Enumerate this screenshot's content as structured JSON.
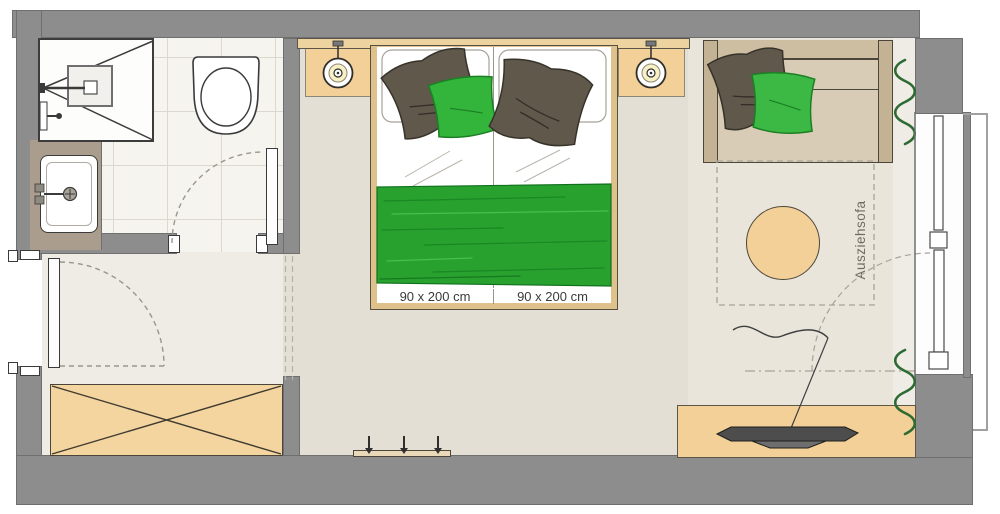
{
  "floor_plan": {
    "bed": {
      "mattress_left_label": "90 x 200 cm",
      "mattress_right_label": "90 x 200 cm"
    },
    "sofa": {
      "label": "Ausziehsofa"
    },
    "colors": {
      "wall_gray": "#8d8d8d",
      "floor_beige": "#e4dfd4",
      "corridor_beige": "#efece6",
      "furniture_tan": "#f2d097",
      "accent_green": "#28a12e",
      "pillow_brown": "#5f584b",
      "curtain_green": "#2e6b33"
    }
  }
}
